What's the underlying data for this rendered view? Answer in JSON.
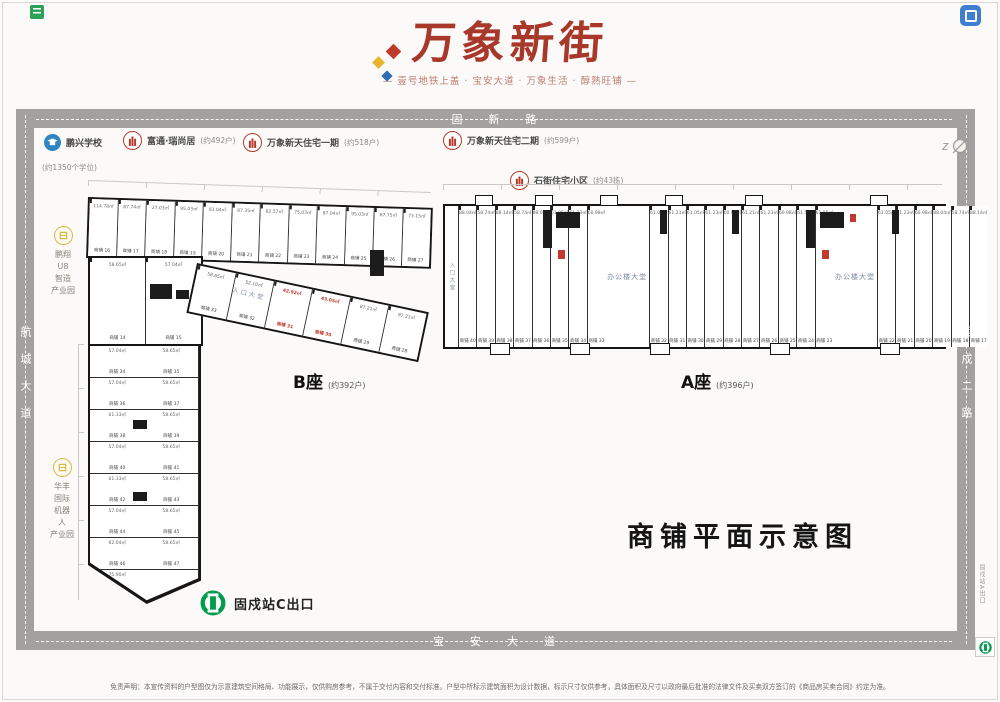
{
  "brand": {
    "logo": "万象新街",
    "tagline": "— 壹号地铁上盖 · 宝安大道 · 万象生活 · 醇熟旺铺 —"
  },
  "roads": {
    "top": "固新路",
    "left": "航城大道",
    "right": "固戍二路",
    "bottom": "宝安大道"
  },
  "legend": {
    "school": {
      "name": "鹏兴学校",
      "detail": "(约1350个学位)"
    },
    "items": [
      {
        "name": "富通·瑞尚居",
        "detail": "(约492户)"
      },
      {
        "name": "万象新天住宅一期",
        "detail": "(约518户)"
      },
      {
        "name": "万象新天住宅二期",
        "detail": "(约599户)"
      },
      {
        "name": "石街住宅小区",
        "detail": "(约43栋)"
      }
    ]
  },
  "parks": {
    "one": {
      "lines": [
        {
          "t": "鹏翔"
        },
        {
          "t": "U8"
        },
        {
          "t": "智造"
        },
        {
          "t": "产业园"
        }
      ]
    },
    "two": {
      "lines": [
        {
          "t": "华丰"
        },
        {
          "t": "国际"
        },
        {
          "t": "机器"
        },
        {
          "t": "人"
        },
        {
          "t": "产业园"
        }
      ]
    }
  },
  "blocks": {
    "b": {
      "name": "B座",
      "count": "(约392户)",
      "entry": "入口大堂",
      "top_row": [
        {
          "a": "114.78㎡",
          "n": "商铺 16"
        },
        {
          "a": "87.74㎡",
          "n": "商铺 17"
        },
        {
          "a": "27.03㎡",
          "n": "商铺 18"
        },
        {
          "a": "95.03㎡",
          "n": "商铺 19"
        },
        {
          "a": "93.04㎡",
          "n": "商铺 20"
        },
        {
          "a": "87.35㎡",
          "n": "商铺 21"
        },
        {
          "a": "82.57㎡",
          "n": "商铺 22"
        },
        {
          "a": "75.03㎡",
          "n": "商铺 23"
        },
        {
          "a": "87.04㎡",
          "n": "商铺 24"
        },
        {
          "a": "95.03㎡",
          "n": "商铺 25"
        },
        {
          "a": "67.75㎡",
          "n": "商铺 26"
        },
        {
          "a": "73.15㎡",
          "n": "商铺 27"
        }
      ],
      "mid_row": [
        {
          "a": "58.65㎡",
          "n": "商铺 33"
        },
        {
          "a": "52.10㎡",
          "n": "商铺 32"
        },
        {
          "a": "42.92㎡",
          "n": "商铺 31",
          "red": true
        },
        {
          "a": "43.05㎡",
          "n": "商铺 30",
          "red": true
        },
        {
          "a": "87.21㎡",
          "n": "商铺 29"
        },
        {
          "a": "87.21㎡",
          "n": "商铺 28"
        }
      ],
      "connector": [
        {
          "a": "58.65㎡",
          "n": "商铺 14"
        },
        {
          "a": "57.04㎡",
          "n": "商铺 15"
        }
      ],
      "left_cells": [
        {
          "n": "商铺 34",
          "a": "57.04㎡"
        },
        {
          "n": "商铺 35",
          "a": "58.65㎡"
        },
        {
          "n": "商铺 36",
          "a": "57.04㎡"
        },
        {
          "n": "商铺 37",
          "a": "58.65㎡"
        },
        {
          "n": "商铺 38",
          "a": "61.33㎡"
        },
        {
          "n": "商铺 39",
          "a": "58.65㎡"
        },
        {
          "n": "商铺 40",
          "a": "57.04㎡"
        },
        {
          "n": "商铺 41",
          "a": "58.65㎡"
        },
        {
          "n": "商铺 42",
          "a": "61.33㎡"
        },
        {
          "n": "商铺 43",
          "a": "58.65㎡"
        },
        {
          "n": "商铺 44",
          "a": "57.04㎡"
        },
        {
          "n": "商铺 45",
          "a": "58.65㎡"
        },
        {
          "n": "商铺 46",
          "a": "62.04㎡"
        },
        {
          "n": "商铺 47",
          "a": "58.65㎡"
        },
        {
          "n": "商铺 48",
          "a": "75.90㎡"
        },
        {
          "n": "",
          "a": ""
        }
      ]
    },
    "a": {
      "name": "A座",
      "count": "(约396户)",
      "entry": "入口大堂",
      "lobby": "办公楼大堂",
      "cells_left": [
        {
          "n": "商铺 40",
          "a": "88.04㎡"
        },
        {
          "n": "商铺 39",
          "a": "58.74㎡"
        },
        {
          "n": "商铺 38",
          "a": "88.14㎡"
        },
        {
          "n": "商铺 37",
          "a": "58.74㎡"
        },
        {
          "n": "商铺 36",
          "a": "88.04㎡"
        },
        {
          "n": "商铺 35",
          "a": "61.05㎡"
        },
        {
          "n": "商铺 34",
          "a": "61.23㎡"
        },
        {
          "n": "商铺 33",
          "a": "60.98㎡"
        }
      ],
      "cells_mid": [
        {
          "n": "商铺 32",
          "a": "61.05㎡"
        },
        {
          "n": "商铺 31",
          "a": "61.23㎡"
        },
        {
          "n": "商铺 30",
          "a": "61.05㎡"
        },
        {
          "n": "商铺 29",
          "a": "61.23㎡"
        },
        {
          "n": "商铺 28",
          "a": "60.98㎡"
        },
        {
          "n": "商铺 27",
          "a": "61.21㎡"
        },
        {
          "n": "商铺 26",
          "a": "61.23㎡"
        },
        {
          "n": "商铺 25",
          "a": "60.98㎡"
        },
        {
          "n": "商铺 24",
          "a": "61.51㎡"
        },
        {
          "n": "商铺 23",
          "a": "61.05㎡"
        }
      ],
      "cells_right": [
        {
          "n": "商铺 22",
          "a": "61.05㎡"
        },
        {
          "n": "商铺 21",
          "a": "61.23㎡"
        },
        {
          "n": "商铺 20",
          "a": "60.98㎡"
        },
        {
          "n": "商铺 19",
          "a": "88.04㎡"
        },
        {
          "n": "商铺 18",
          "a": "58.74㎡"
        },
        {
          "n": "商铺 17",
          "a": "88.14㎡"
        }
      ]
    }
  },
  "captions": {
    "plan_title": "商铺平面示意图",
    "metro_exit_c": "固戍站C出口",
    "metro_exit_a": "固戍站A出口"
  },
  "disclaimer": "免责声明：本宣传资料的户型图仅为示意建筑空间格局、功能展示，仅供购房参考，不属于交付内容和交付标准。户型中所标示建筑面积为设计数据，标示尺寸仅供参考，具体面积及尺寸以政府最后批准的法律文件及买卖双方签订的《商品房买卖合同》约定为准。",
  "colors": {
    "brand_red": "#a8392a",
    "road_gray": "#a2a19f",
    "metro_green": "#009b4c",
    "legend_red": "#b5392a",
    "school_blue": "#2f86c2",
    "park_yellow": "#d9b94b",
    "highlight_red": "#c4392e"
  }
}
